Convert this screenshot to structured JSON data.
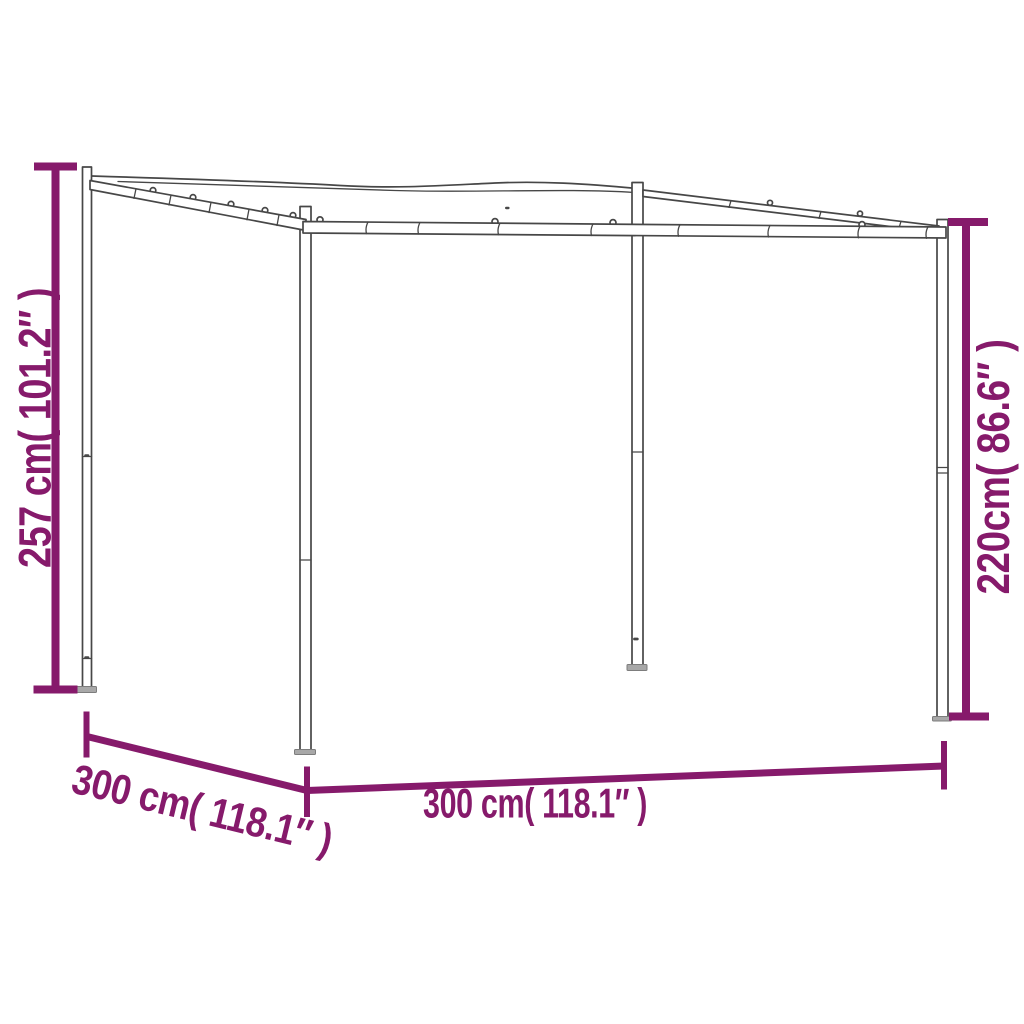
{
  "figure": {
    "description": "Wireframe product dimension diagram of a 4-post slant-roof canopy gazebo"
  },
  "labels": {
    "left_height": "257 cm( 101.2″ )",
    "right_height": "220cm( 86.6″ )",
    "depth": "300 cm( 118.1″ )",
    "width": "300 cm( 118.1″ )"
  },
  "colors": {
    "dimension": "#861a6b",
    "structure": "#474747",
    "base": "#a8a8a8"
  }
}
